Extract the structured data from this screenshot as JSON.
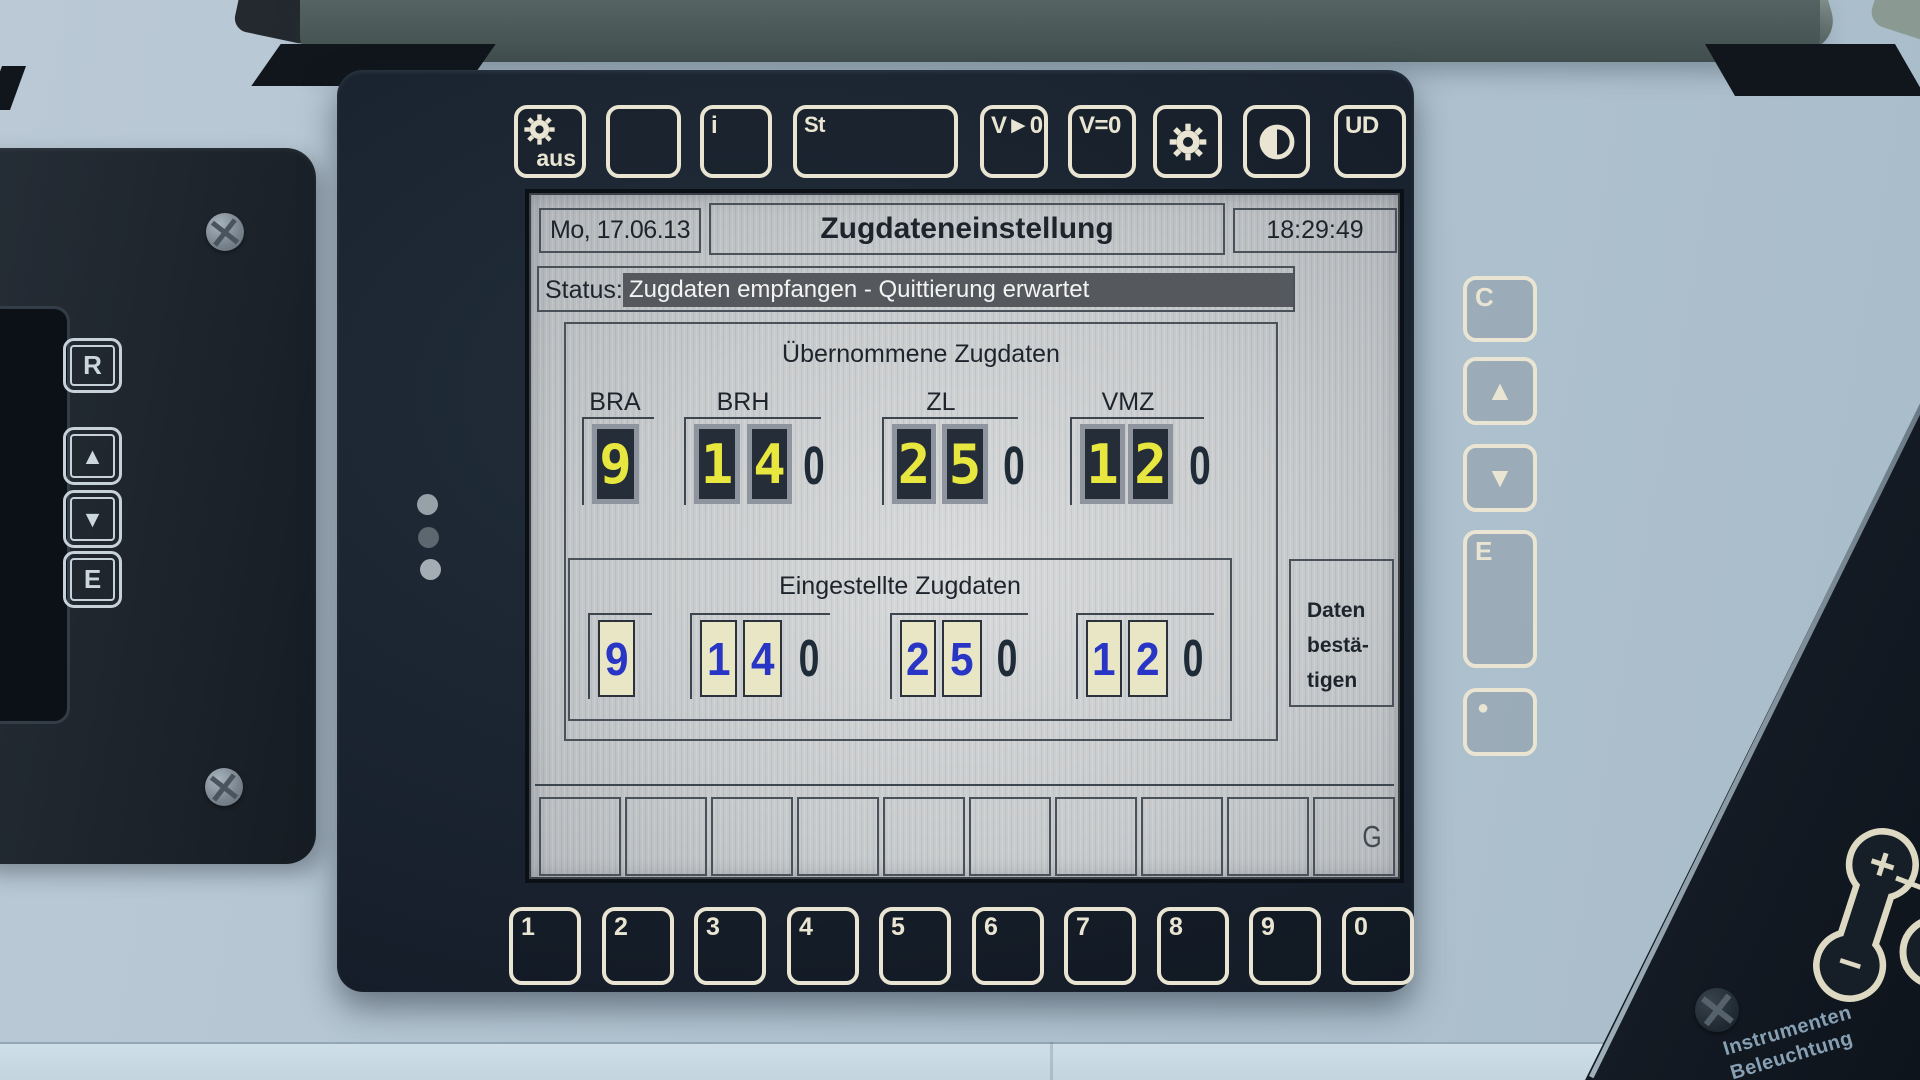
{
  "colors": {
    "button_cream": "#e9e5d2",
    "segment_yellow": "#e8e73f",
    "entered_blue": "#2835c5",
    "status_bar": "#55595e",
    "bezel": "#1a2430"
  },
  "top_buttons": {
    "aus": {
      "icon": "gear-icon",
      "label": "aus"
    },
    "blank": {
      "label": ""
    },
    "info": {
      "label": "i"
    },
    "st": {
      "label": "St"
    },
    "v_gt_0": {
      "label": "V►0"
    },
    "v_eq_0": {
      "label": "V=0"
    },
    "sun": {
      "icon": "sun-icon",
      "label": ""
    },
    "contrast": {
      "icon": "contrast-icon",
      "label": ""
    },
    "ud": {
      "label": "UD"
    }
  },
  "screen": {
    "date": "Mo, 17.06.13",
    "title": "Zugdateneinstellung",
    "time": "18:29:49",
    "status_label": "Status:",
    "status_message": "Zugdaten empfangen - Quittierung erwartet",
    "received": {
      "title": "Übernommene Zugdaten",
      "columns": [
        {
          "label": "BRA",
          "digits": [
            "9"
          ],
          "suffix": ""
        },
        {
          "label": "BRH",
          "digits": [
            "1",
            "4"
          ],
          "suffix": "0"
        },
        {
          "label": "ZL",
          "digits": [
            "2",
            "5"
          ],
          "suffix": "0"
        },
        {
          "label": "VMZ",
          "digits": [
            "1",
            "2"
          ],
          "suffix": "0"
        }
      ]
    },
    "entered": {
      "title": "Eingestellte Zugdaten",
      "columns": [
        {
          "digits": [
            "9"
          ],
          "suffix": ""
        },
        {
          "digits": [
            "1",
            "4"
          ],
          "suffix": "0"
        },
        {
          "digits": [
            "2",
            "5"
          ],
          "suffix": "0"
        },
        {
          "digits": [
            "1",
            "2"
          ],
          "suffix": "0"
        }
      ]
    },
    "confirm": {
      "line1": "Daten",
      "line2": "bestä-",
      "line3": "tigen"
    },
    "softkeys": [
      "",
      "",
      "",
      "",
      "",
      "",
      "",
      "",
      "",
      "G"
    ]
  },
  "number_keys": [
    "1",
    "2",
    "3",
    "4",
    "5",
    "6",
    "7",
    "8",
    "9",
    "0"
  ],
  "right_keys": {
    "clear": "C",
    "enter": "E"
  },
  "left_panel_keys": {
    "release": "R",
    "enter": "E"
  },
  "glyphs": {
    "up": "▲",
    "down": "▼",
    "dot": "●"
  },
  "console": {
    "label_line1": "Instrumenten",
    "label_line2": "Beleuchtung",
    "plus": "+",
    "minus": "−"
  }
}
